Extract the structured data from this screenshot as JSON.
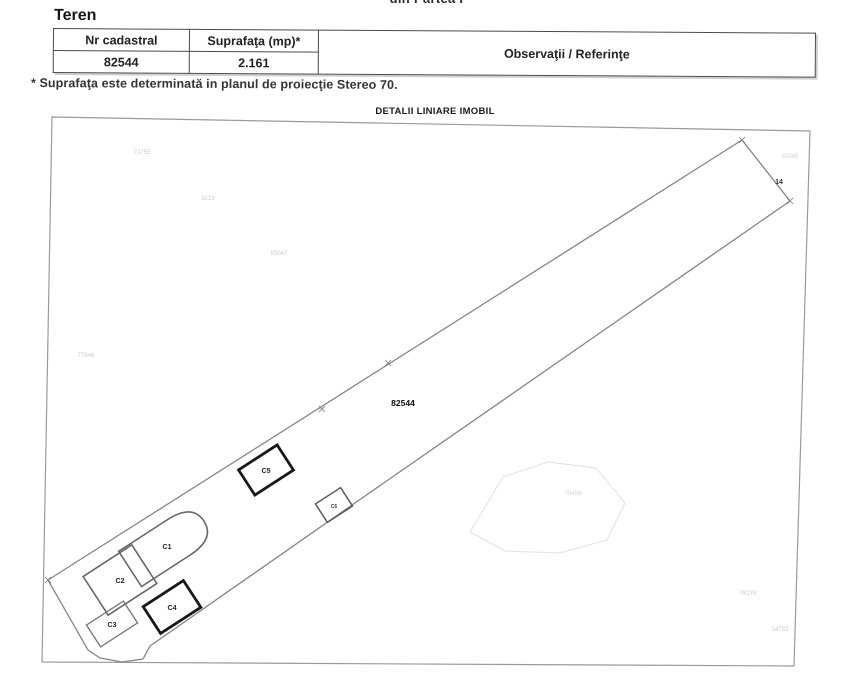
{
  "page": {
    "top_fragment": "din Partea I",
    "section_title": "Teren",
    "footnote": "* Suprafaţa este determinată in planul de proiecţie Stereo 70."
  },
  "table": {
    "headers": [
      "Nr cadastral",
      "Suprafaţa (mp)*",
      "Observaţii / Referinţe"
    ],
    "rows": [
      [
        "82544",
        "2.161",
        ""
      ]
    ]
  },
  "map": {
    "title": "DETALII LINIARE IMOBIL",
    "parcel_label": "82544",
    "buildings": [
      "C1",
      "C2",
      "C3",
      "C4",
      "C5",
      "C6"
    ],
    "point_label": "14",
    "neighbor_labels": [
      "73755",
      "9219",
      "83047",
      "77846",
      "82545",
      "78456",
      "78174",
      "14733"
    ]
  }
}
